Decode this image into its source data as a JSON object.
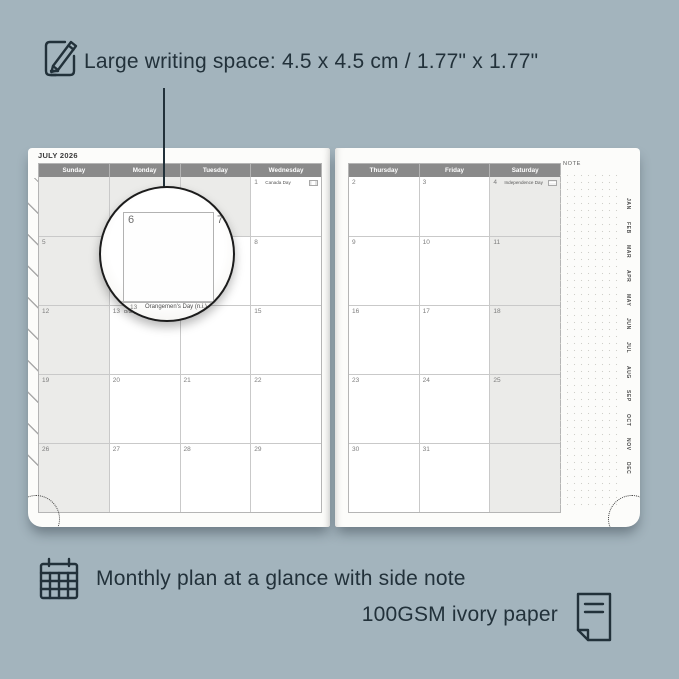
{
  "colors": {
    "background": "#a3b4bd",
    "ink": "#22313a",
    "page": "#fcfcfa",
    "shaded_cell": "#ebebe9",
    "header_bar": "#8a8a8a",
    "grid_line": "#c9c9c9"
  },
  "annotations": {
    "top": {
      "icon": "pencil-note-icon",
      "text": "Large writing space: 4.5 x 4.5 cm / 1.77\" x 1.77\""
    },
    "bottom_plan": {
      "icon": "calendar-grid-icon",
      "text": "Monthly plan at a glance with side note"
    },
    "bottom_paper": {
      "icon": "paper-sheet-icon",
      "text": "100GSM ivory paper"
    }
  },
  "planner": {
    "month_title": "JULY 2026",
    "note_label": "NOTE",
    "left_page": {
      "day_headers": [
        "Sunday",
        "Monday",
        "Tuesday",
        "Wednesday"
      ],
      "weeks": [
        [
          "",
          "",
          "",
          {
            "date": "1",
            "holiday": "Canada Day",
            "flag": "CA"
          }
        ],
        [
          "5",
          "6",
          "7",
          "8"
        ],
        [
          "12",
          {
            "date": "13",
            "holiday": "Orangemen's Day (N.I.)",
            "flag": "NI"
          },
          "14",
          "15"
        ],
        [
          "19",
          "20",
          "21",
          "22"
        ],
        [
          "26",
          "27",
          "28",
          "29"
        ]
      ]
    },
    "right_page": {
      "day_headers": [
        "Thursday",
        "Friday",
        "Saturday"
      ],
      "weeks": [
        [
          {
            "date": "2"
          },
          {
            "date": "3"
          },
          {
            "date": "4",
            "holiday": "Independence Day",
            "flag": "US"
          }
        ],
        [
          "9",
          "10",
          "11"
        ],
        [
          "16",
          "17",
          "18"
        ],
        [
          "23",
          "24",
          "25"
        ],
        [
          "30",
          "31",
          ""
        ]
      ]
    },
    "month_tabs": [
      "JAN",
      "FEB",
      "MAR",
      "APR",
      "MAY",
      "JUN",
      "JUL",
      "AUG",
      "SEP",
      "OCT",
      "NOV",
      "DEC"
    ],
    "magnifier": {
      "primary_date": "6",
      "adjacent_date": "7",
      "next_row_date": "13",
      "next_row_holiday": "Orangemen's Day (n.i.)"
    }
  }
}
